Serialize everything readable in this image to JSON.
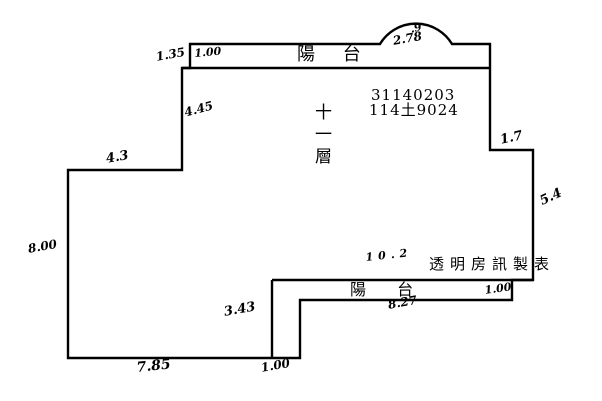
{
  "document": {
    "kind": "building-floor-plan-survey-sketch",
    "ink_color": "#000000",
    "background_color": "#ffffff"
  },
  "plan": {
    "floor_label": "十一層",
    "case_number": "31140203",
    "building_number": "114土9024",
    "publisher": "透明房訊製表",
    "upper_balcony_label": "陽 台",
    "lower_balcony_label": "陽 台"
  },
  "dimensions": {
    "upper_balcony_offset": "1.35",
    "upper_balcony_left": "1.00",
    "bay_depth": ".9",
    "bay_width": "2.78",
    "upper_left_wall": "4.45",
    "left_step_wall": "4.3",
    "left_wall": "8.00",
    "right_step_wall": "1.7",
    "right_wall": "5.4",
    "main_bottom_wall": "10.2",
    "lower_balcony_end": "1.00",
    "lower_balcony_width": "8.27",
    "duct_wall": "3.43",
    "bottom_wall": "7.85",
    "bottom_notch": "1.00"
  }
}
